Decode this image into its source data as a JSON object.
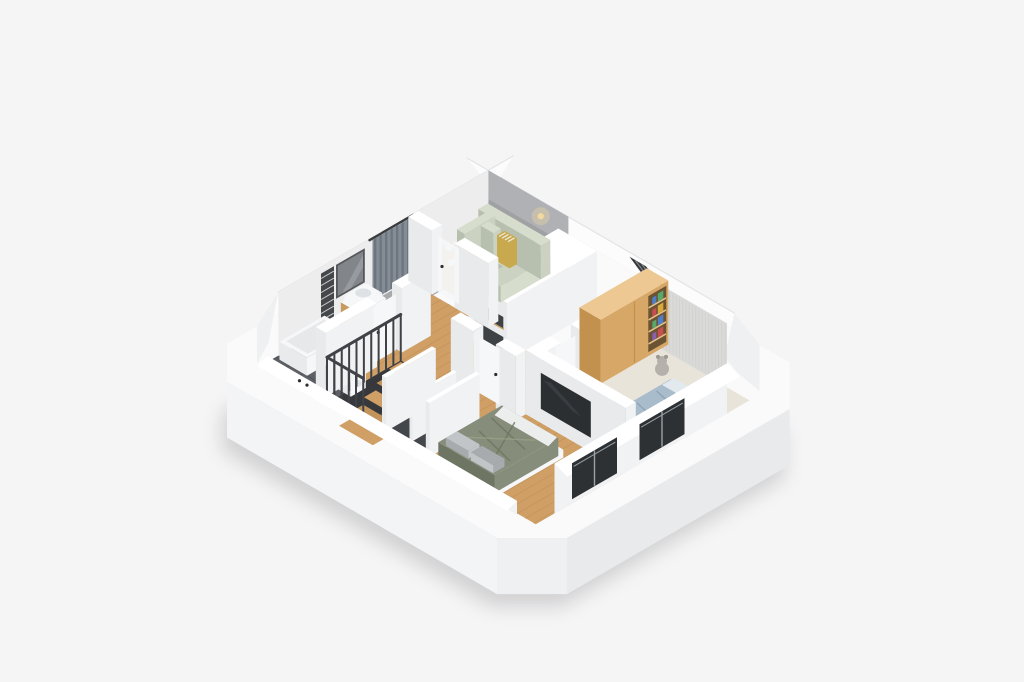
{
  "meta": {
    "title": "3D isometric floor plan render",
    "description": "Isometric cutaway 3D render of a furnished attic apartment floor plan on a light gray background"
  },
  "colors": {
    "bg": "#f5f5f6",
    "shadow": "#000000",
    "plinth_top": "#fafafb",
    "plinth_se": "#e9eaec",
    "plinth_sw": "#f3f4f5",
    "plinth_ch": "#eff0f1",
    "band": "#fcfcfd",
    "band_edge": "#e3e4e6",
    "wall_top": "#ffffff",
    "wall_face": "#f1f2f3",
    "wall_face2": "#e9eaec",
    "nw_face": "#ededee",
    "backwall": "#9fa1a3",
    "backwall2": "#b6b8ba",
    "wood": "#cf9f66",
    "wood_dark": "#b0824a",
    "wood_deep": "#c9945a",
    "tread": "#c2945c",
    "stair_void": "#36383b",
    "tile": "#5d6064",
    "tile_line": "#4b4e52",
    "carpet": "#e9e4da",
    "bay_floor": "#a8a9ab",
    "curtain": "#848c95",
    "curtain_dark": "#6d757e",
    "rod": "#3a3c3e",
    "mirror": "#82858a",
    "mirror_hi": "#a9adb1",
    "mirror_frame": "#55585b",
    "mosaic": "#45484b",
    "mosaic_dot": "#e8e9ea",
    "white": "#f6f7f8",
    "vanity_wood": "#c79a5e",
    "basin": "#dfe2e4",
    "tub_in": "#e6e8e9",
    "sofa": "#cbd2c2",
    "sofa_light": "#d7ddcd",
    "sofa_dark": "#b7bfae",
    "pillow_stripe": "#c9a94e",
    "table": "#c9913f",
    "table_top": "#d79e4f",
    "flower": "#f2f3f0",
    "lamp": "#f2d9a0",
    "core_niche": "#3f4245",
    "wardrobe": "#d7a768",
    "wardrobe_side": "#c2914d",
    "wardrobe_top": "#edc892",
    "shelf_bg": "#6b5233",
    "shelf_line": "#e3c08a",
    "book1": "#c94f4f",
    "book2": "#4f7fc9",
    "book3": "#d9a93c",
    "book4": "#58a86b",
    "book5": "#8a5fb0",
    "textured": "#dadad8",
    "textured_line": "#cdcdca",
    "skylight": "#35393c",
    "skylight_line": "#7e8286",
    "teddy": "#b5b0aa",
    "teddy_dark": "#9d988f",
    "kidbed": "#a9bccb",
    "kidbed_fold": "#8fa5b6",
    "kidpillow": "#e2e9ef",
    "chair": "#9fcbdf",
    "chair_dark": "#7fb3cc",
    "desk": "#e5ba77",
    "desk_edge": "#d0a360",
    "plant": "#4e9c45",
    "plant_dark": "#3c7f35",
    "plant_light": "#72bb60",
    "pot": "#4a4a48",
    "tv": "#2c2f32",
    "tv_sheen": "#3e4246",
    "duvet": "#868d7b",
    "duvet_dark": "#6e7562",
    "duvet_light": "#9aa189",
    "sheet": "#eceeee",
    "mpillow1": "#c2c5c7",
    "mpillow2": "#a7abad",
    "closet_in": "#4c4f53",
    "closet_back": "#43464a",
    "rail": "#c9995c",
    "hanger": "#e2d2ae",
    "baluster": "#3f4246",
    "window": "#2e3134",
    "window_frame": "#9aa0a5",
    "handle": "#2b2d2f"
  },
  "building": {
    "view": "isometric cutaway",
    "features": [
      "sloped attic walls",
      "staircase opening with black metal balustrade",
      "roof skylight window",
      "white base plinth slab",
      "chamfered corners"
    ]
  },
  "rooms": [
    {
      "name": "living-room",
      "floor": "wood",
      "furniture": [
        "corner sofa",
        "striped cushion",
        "round coffee table with flowers",
        "floor-to-ceiling gray curtains",
        "wall lamp"
      ]
    },
    {
      "name": "bathroom",
      "floor": "dark gray tile",
      "furniture": [
        "vanity with washbasin",
        "wall mirror",
        "mosaic tile accent strip",
        "bathtub",
        "washing machine"
      ]
    },
    {
      "name": "hallway",
      "floor": "wood",
      "furniture": [
        "staircase with black balustrade",
        "open built-in closet with hanger rails"
      ]
    },
    {
      "name": "kids-bedroom",
      "floor": "beige carpet",
      "furniture": [
        "wooden wardrobe with bookshelf",
        "single bed with blue-gray bedding",
        "desk",
        "blue desk chair",
        "teddy bear",
        "potted plant",
        "knit textured accent wall"
      ]
    },
    {
      "name": "master-bedroom",
      "floor": "wood",
      "furniture": [
        "double bed with olive duvet",
        "wall-mounted TV",
        "open closet"
      ]
    }
  ]
}
